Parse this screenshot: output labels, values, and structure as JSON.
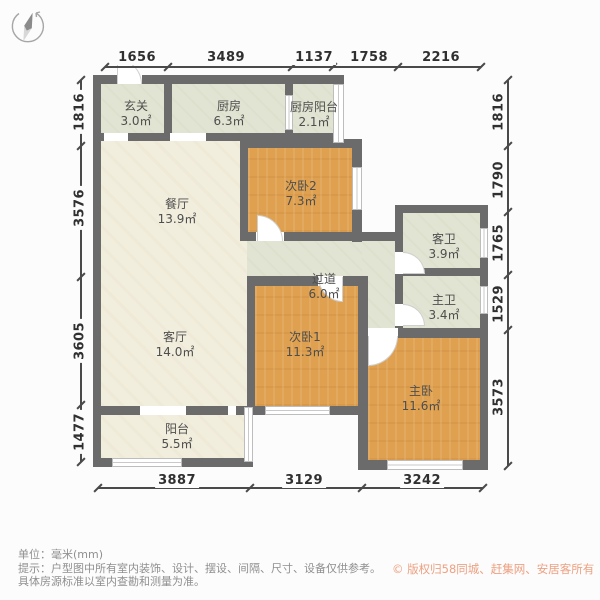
{
  "meta": {
    "type": "floor-plan",
    "source_style": "real-estate listing floor plan"
  },
  "colors": {
    "wall": "#6b6b6b",
    "floor_warm": "#f2eedd",
    "floor_cool": "#e1e4d2",
    "floor_wood": "#dfa04f",
    "line": "#4a4a4a",
    "dim_text": "#303030",
    "label_text": "#4e4e4e",
    "accent_copyright": "#eda182"
  },
  "compass": {
    "icon": "compass-needle"
  },
  "dimensions": {
    "top": [
      "1656",
      "3489",
      "1137",
      "1758",
      "2216"
    ],
    "left": [
      "1816",
      "3576",
      "3605",
      "1477"
    ],
    "right": [
      "1816",
      "1790",
      "1765",
      "1529",
      "3573"
    ],
    "bottom": [
      "3887",
      "3129",
      "3242"
    ]
  },
  "rooms": [
    {
      "name": "玄关",
      "area": "3.0㎡"
    },
    {
      "name": "厨房",
      "area": "6.3㎡"
    },
    {
      "name": "厨房阳台",
      "area": "2.1㎡"
    },
    {
      "name": "餐厅",
      "area": "13.9㎡"
    },
    {
      "name": "次卧2",
      "area": "7.3㎡"
    },
    {
      "name": "客卫",
      "area": "3.9㎡"
    },
    {
      "name": "过道",
      "area": "6.0㎡"
    },
    {
      "name": "主卫",
      "area": "3.4㎡"
    },
    {
      "name": "客厅",
      "area": "14.0㎡"
    },
    {
      "name": "次卧1",
      "area": "11.3㎡"
    },
    {
      "name": "主卧",
      "area": "11.6㎡"
    },
    {
      "name": "阳台",
      "area": "5.5㎡"
    }
  ],
  "footer": {
    "unit_label": "单位：毫米(mm)",
    "disclaimer_line1": "提示：户型图中所有室内装饰、设计、摆设、间隔、尺寸、设备仅供参考。",
    "disclaimer_line2": "具体房源标准以室内查勘和测量为准。",
    "copyright": "© 版权归58同城、赶集网、安居客所有"
  }
}
